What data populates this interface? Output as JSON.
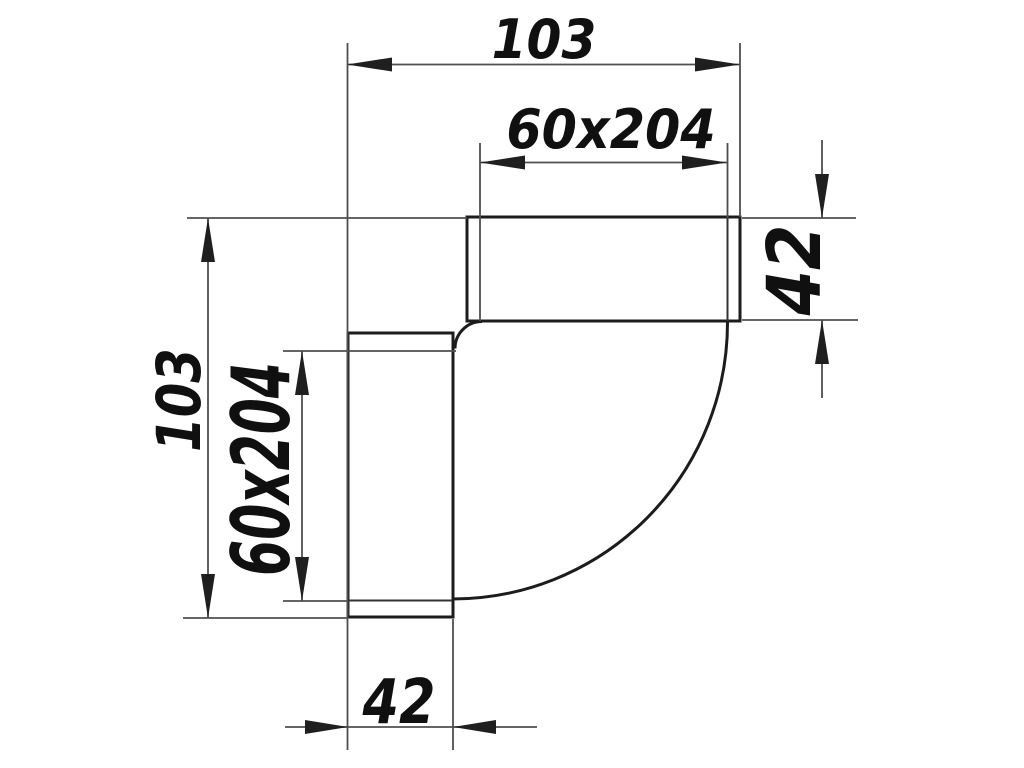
{
  "drawing": {
    "description": "90-degree vertical elbow for flat duct, side view with dimensions",
    "labels": {
      "top_width": "103",
      "top_duct": "60x204",
      "right_socket": "42",
      "left_height": "103",
      "left_duct": "60x204",
      "bottom_socket": "42"
    },
    "colors": {
      "background": "#ffffff",
      "outline": "#1c1c1c",
      "lip": "#333333",
      "dimension": "#4f4f4f",
      "arrow": "#1f1f1f",
      "label": "#101010"
    }
  }
}
